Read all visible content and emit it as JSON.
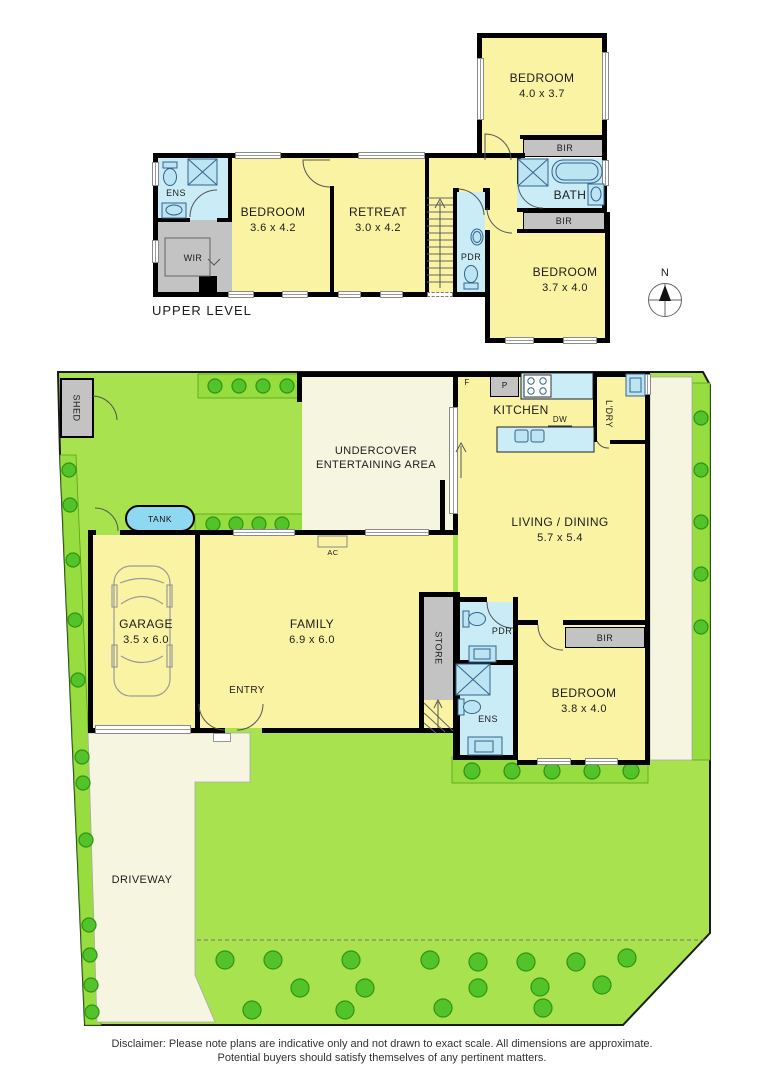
{
  "upper_level": {
    "section_label": "UPPER LEVEL",
    "rooms": {
      "bedroom_top": {
        "name": "BEDROOM",
        "dims": "4.0 x 3.7"
      },
      "bedroom_left": {
        "name": "BEDROOM",
        "dims": "3.6 x 4.2"
      },
      "retreat": {
        "name": "RETREAT",
        "dims": "3.0 x 4.2"
      },
      "bedroom_right": {
        "name": "BEDROOM",
        "dims": "3.7 x 4.0"
      },
      "bath": "BATH",
      "ens": "ENS",
      "wir": "WIR",
      "pdr": "PDR",
      "bir_top": "BIR",
      "bir_bottom": "BIR"
    }
  },
  "compass": {
    "north": "N"
  },
  "ground_level": {
    "outdoor": {
      "shed": "SHED",
      "tank": "TANK",
      "driveway": "DRIVEWAY",
      "undercover": "UNDERCOVER ENTERTAINING AREA",
      "ac": "AC"
    },
    "rooms": {
      "kitchen": "KITCHEN",
      "fridge": "F",
      "pantry": "P",
      "dishwasher": "DW",
      "laundry": "L'DRY",
      "living": {
        "name": "LIVING / DINING",
        "dims": "5.7 x 5.4"
      },
      "garage": {
        "name": "GARAGE",
        "dims": "3.5 x 6.0"
      },
      "family": {
        "name": "FAMILY",
        "dims": "6.9 x 6.0"
      },
      "entry": "ENTRY",
      "store": "STORE",
      "pdr": "PDR",
      "ens": "ENS",
      "bir": "BIR",
      "bedroom": {
        "name": "BEDROOM",
        "dims": "3.8 x 4.0"
      }
    }
  },
  "disclaimer": {
    "line1": "Disclaimer: Please note plans are indicative only and not drawn to exact scale. All dimensions are approximate.",
    "line2": "Potential buyers should satisfy themselves of any pertinent matters."
  },
  "colors": {
    "room_yellow": "#FAF3A3",
    "wet_blue": "#C9ECF7",
    "fixture_blue": "#BCE4F2",
    "counter_blue": "#CBEDF8",
    "gray": "#C3C3C3",
    "lawn": "#A8E24E",
    "bed_green": "#97DD3F",
    "bush_green": "#53C32A",
    "paving": "#F6F5E0",
    "tank_blue": "#8FD8F2",
    "wall": "#000000"
  }
}
